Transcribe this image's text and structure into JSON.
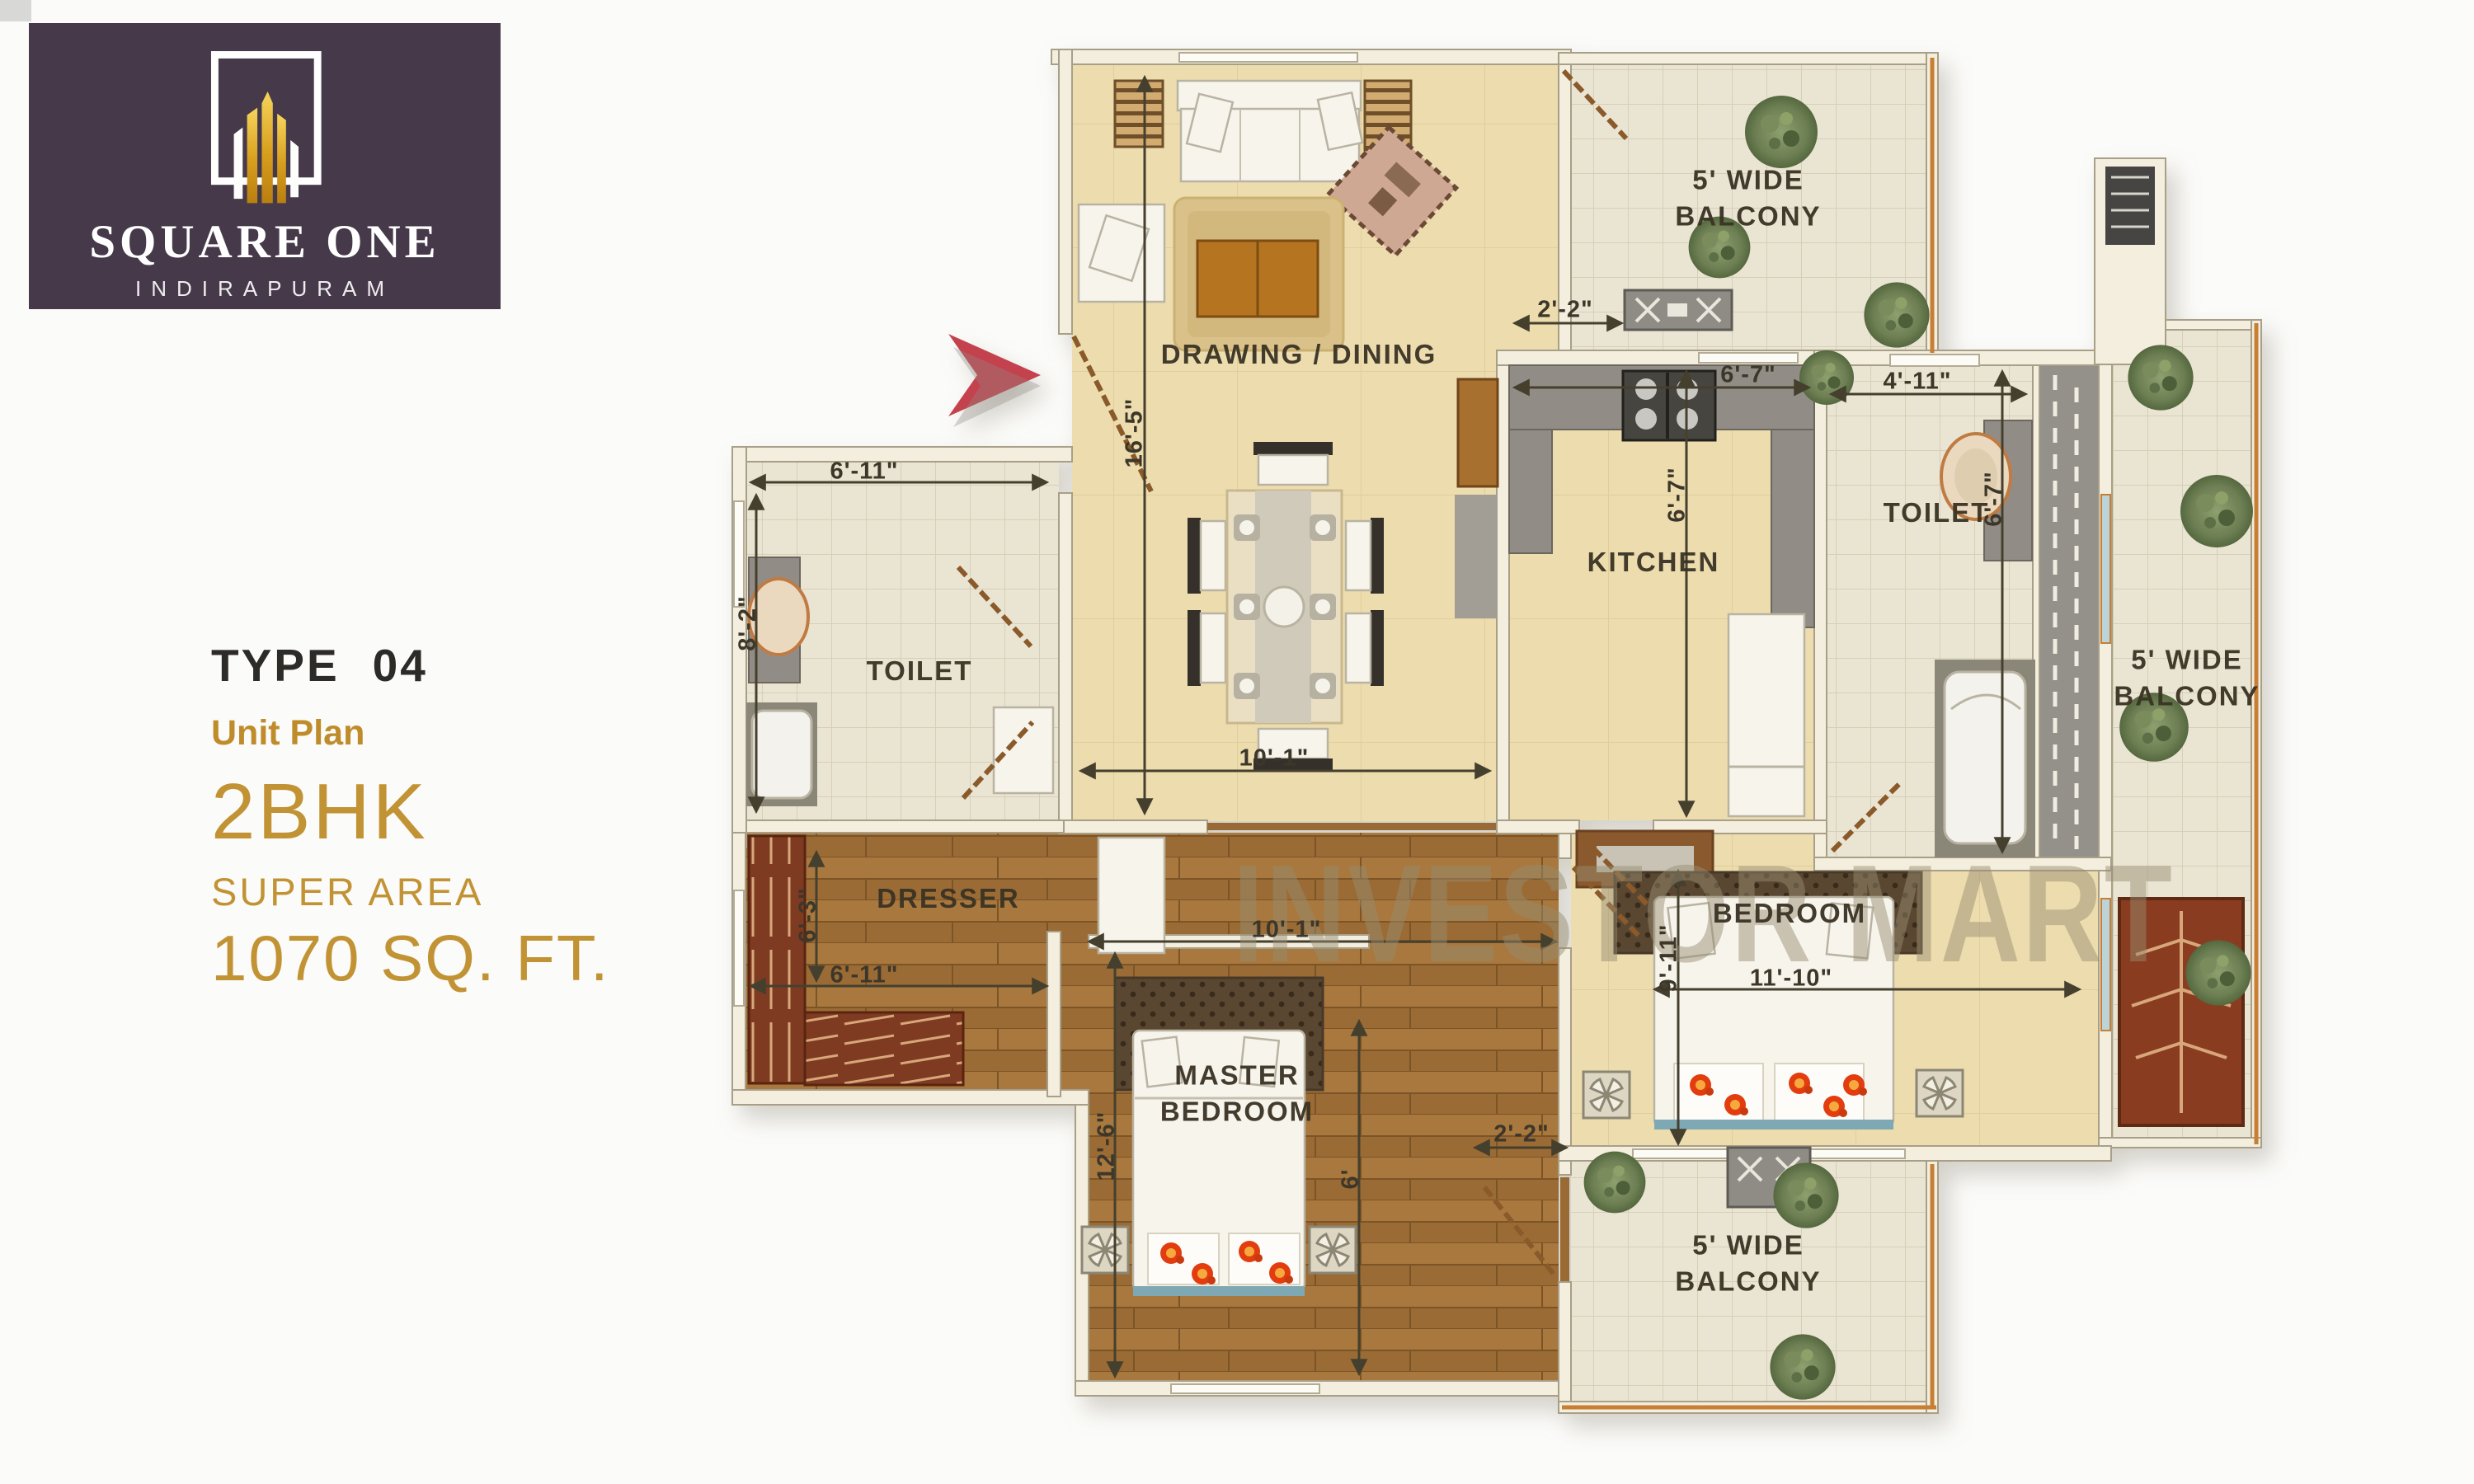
{
  "logo": {
    "brand": "SQUARE ONE",
    "location": "INDIRAPURAM",
    "bg_color": "#463a4a",
    "gold_color": "#d9a929"
  },
  "info": {
    "type_label": "TYPE",
    "type_number": "04",
    "subtitle": "Unit Plan",
    "config": "2BHK",
    "area_label": "SUPER AREA",
    "area_value": "1070 SQ. FT.",
    "accent_color": "#c29334",
    "dark_color": "#2d2b28"
  },
  "watermark": {
    "text": "INVESTOR MART"
  },
  "plan": {
    "colors": {
      "wall": "#f3eedd",
      "floor_cream": "#ecdcae",
      "floor_tile": "#eae4d2",
      "floor_wood": "#a8783e",
      "counter_gray": "#918d86",
      "arrow_red": "#c4424d",
      "balcony_rail_orange": "#c77f35"
    },
    "rooms": {
      "drawing_dining": "DRAWING / DINING",
      "kitchen": "KITCHEN",
      "toilet_left": "TOILET",
      "toilet_right": "TOILET",
      "dresser": "DRESSER",
      "master_bedroom": "MASTER BEDROOM",
      "bedroom": "BEDROOM",
      "balcony_top": "5' WIDE BALCONY",
      "balcony_right": "5' WIDE BALCONY",
      "balcony_bottom": "5' WIDE BALCONY"
    },
    "dims": {
      "drawing_height": "16'-5\"",
      "dining_width": "10'-1\"",
      "kitchen_gap": "2'-2\"",
      "kitchen_width": "6'-7\"",
      "kitchen_height": "6'-7\"",
      "toilet_right_width": "4'-11\"",
      "toilet_right_height": "6'-7\"",
      "toilet_left_width": "6'-11\"",
      "toilet_left_height": "8'-2\"",
      "dresser_width": "6'-11\"",
      "dresser_height": "6'-3\"",
      "corridor_width": "10'-1\"",
      "master_height": "12'-6\"",
      "balcony_gap": "2'-2\"",
      "passage_height": "6'",
      "bedroom_height": "9'-11\"",
      "bedroom_width": "11'-10\""
    }
  }
}
